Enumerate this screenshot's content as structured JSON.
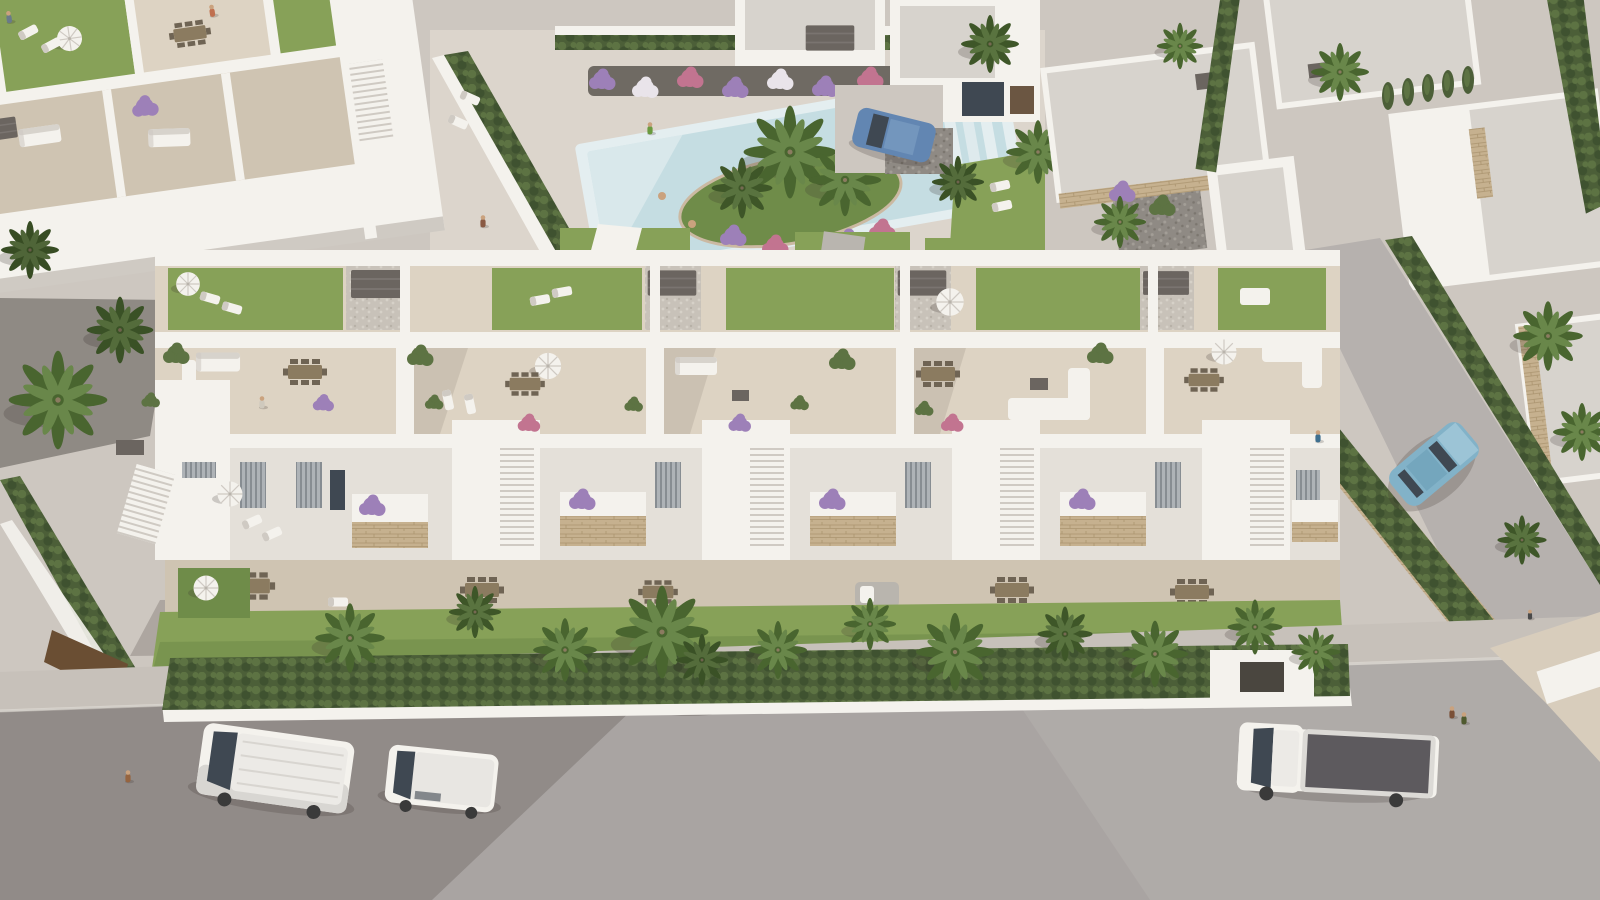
{
  "scene": {
    "alt": "aerial-3d-render-of-white-mediterranean-residential-development",
    "type": "architectural-visualization"
  },
  "areas": {
    "top_left_apartments": "neighbor-apartment-roof-terraces",
    "pool": "communal-pool-garden",
    "villas": "detached-villa-cluster",
    "side_street": "side-street-with-hedges",
    "main_block": "main-townhouse-block-five-units",
    "front_garden": "front-gardens-with-palms",
    "street": "front-street",
    "left_garden": "west-side-garden"
  },
  "vehicles": [
    {
      "name": "white-panel-van",
      "color": "#efede9"
    },
    {
      "name": "white-minivan",
      "color": "#ebe9e5"
    },
    {
      "name": "white-pickup-truck",
      "color": "#efede9"
    },
    {
      "name": "teal-sedan",
      "color": "#82b2c8"
    },
    {
      "name": "blue-hatchback",
      "color": "#6286b2"
    }
  ],
  "palette": {
    "pave": "#cdc7c0",
    "pave-light": "#dcd5cc",
    "pave-dark": "#c0b9b0",
    "road": "#a9a4a2",
    "road-light": "#b6b1ae",
    "sidewalk": "#c7c1ba",
    "white": "#f4f2ed",
    "white-shade": "#e4e0d9",
    "white-dark": "#cfcac3",
    "tile": "#ddd3c3",
    "tile-shade": "#cfc4b2",
    "lawn": "#87a158",
    "lawn-dark": "#6f8c49",
    "hedge": "#4c5f38",
    "hedge-light": "#5d7343",
    "palm": "#69874a",
    "palm-dark": "#49652f",
    "pool": "#c5dde2",
    "pool-light": "#e4eef0",
    "stone": "#c6b18f",
    "gravel": "#8f8a84",
    "gravel-dark": "#6f6a63",
    "pergola": "#6b6560",
    "wood": "#8b7b60",
    "wood-dark": "#6f6454",
    "glass": "#3f4852",
    "truck-bed": "#5d5a5e",
    "car-teal": "#82b2c8",
    "car-blue": "#6286b2",
    "skin": "#caa27e",
    "shadow": "rgba(60,52,45,0.22)"
  }
}
